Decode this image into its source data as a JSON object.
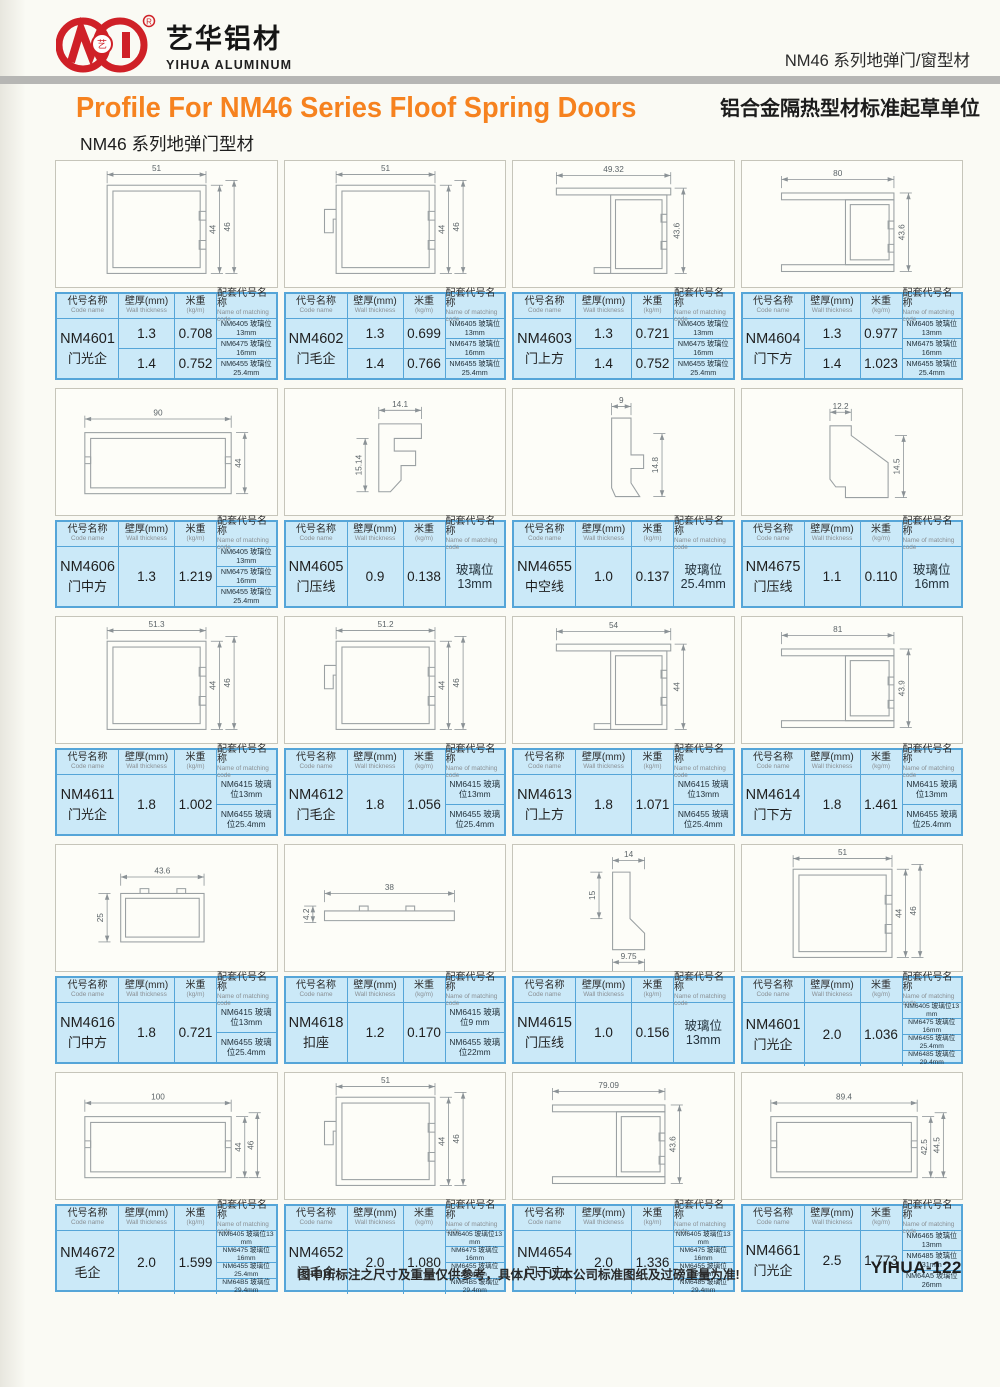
{
  "brand": {
    "company_cn": "艺华铝材",
    "company_en": "YIHUA ALUMINUM",
    "registered": "®"
  },
  "header": {
    "right_line1": "NM46 系列地弹门/窗型材",
    "right_line2": "铝合金隔热型材标准起草单位",
    "title": "Profile For NM46 Series Floof Spring Doors",
    "subtitle": "NM46 系列地弹门型材"
  },
  "table_headers": {
    "col1_cn": "代号名称",
    "col1_en": "Code name",
    "col2_cn": "壁厚(mm)",
    "col2_en": "Wall thickness",
    "col3_cn": "米重",
    "col3_en": "(kg/m)",
    "col4_cn": "配套代号名称",
    "col4_en": "Name of matching code"
  },
  "colors": {
    "accent_orange": "#f6821f",
    "brand_red": "#cf2027",
    "table_bg": "#cbe9f8",
    "table_border": "#55a5d8",
    "gray_bar": "#b6b6b4"
  },
  "footer": {
    "note": "图中所标注之尺寸及重量仅供参考，具体尺寸以本公司标准图纸及过磅重量为准!",
    "page_code": "YIHUA-122"
  },
  "cells": [
    {
      "code": "NM4601",
      "name": "门光企",
      "thickness": [
        "1.3",
        "1.4"
      ],
      "weight": [
        "0.708",
        "0.752"
      ],
      "matching": {
        "style": "list",
        "items": [
          "NM6405 玻璃位13mm",
          "NM6475 玻璃位16mm",
          "NM6455 玻璃位25.4mm"
        ]
      },
      "drawing": {
        "shape": "sqtube",
        "top": "51",
        "right": [
          "44",
          "46"
        ]
      }
    },
    {
      "code": "NM4602",
      "name": "门毛企",
      "thickness": [
        "1.3",
        "1.4"
      ],
      "weight": [
        "0.699",
        "0.766"
      ],
      "matching": {
        "style": "list",
        "items": [
          "NM6405 玻璃位13mm",
          "NM6475 玻璃位16mm",
          "NM6455 玻璃位25.4mm"
        ]
      },
      "drawing": {
        "shape": "sqtube_hook",
        "top": "51",
        "right": [
          "44",
          "46"
        ]
      }
    },
    {
      "code": "NM4603",
      "name": "门上方",
      "thickness": [
        "1.3",
        "1.4"
      ],
      "weight": [
        "0.721",
        "0.752"
      ],
      "matching": {
        "style": "list",
        "items": [
          "NM6405 玻璃位13mm",
          "NM6475 玻璃位16mm",
          "NM6455 玻璃位25.4mm"
        ]
      },
      "drawing": {
        "shape": "tflange",
        "top": "49.32",
        "right": [
          "43.6"
        ]
      }
    },
    {
      "code": "NM4604",
      "name": "门下方",
      "thickness": [
        "1.3",
        "1.4"
      ],
      "weight": [
        "0.977",
        "1.023"
      ],
      "matching": {
        "style": "list",
        "items": [
          "NM6405 玻璃位13mm",
          "NM6475 玻璃位16mm",
          "NM6455 玻璃位25.4mm"
        ]
      },
      "drawing": {
        "shape": "dflange",
        "top": "80",
        "right": [
          "43.6"
        ]
      }
    },
    {
      "code": "NM4606",
      "name": "门中方",
      "thickness": [
        "1.3"
      ],
      "weight": [
        "1.219"
      ],
      "matching": {
        "style": "list",
        "items": [
          "NM6405 玻璃位13mm",
          "NM6475 玻璃位16mm",
          "NM6455 玻璃位25.4mm"
        ]
      },
      "drawing": {
        "shape": "wtube",
        "top": "90",
        "right": [
          "44"
        ]
      }
    },
    {
      "code": "NM4605",
      "name": "门压线",
      "thickness": [
        "0.9"
      ],
      "weight": [
        "0.138"
      ],
      "matching": {
        "style": "single",
        "items": [
          "玻璃位13mm"
        ]
      },
      "drawing": {
        "shape": "clip",
        "top": "14.1",
        "left": "15.14"
      }
    },
    {
      "code": "NM4655",
      "name": "中空线",
      "thickness": [
        "1.0"
      ],
      "weight": [
        "0.137"
      ],
      "matching": {
        "style": "single",
        "items": [
          "玻璃位25.4mm"
        ]
      },
      "drawing": {
        "shape": "hollow",
        "top": "9",
        "right": [
          "14.8"
        ]
      }
    },
    {
      "code": "NM4675",
      "name": "门压线",
      "thickness": [
        "1.1"
      ],
      "weight": [
        "0.110"
      ],
      "matching": {
        "style": "single",
        "items": [
          "玻璃位16mm"
        ]
      },
      "drawing": {
        "shape": "slant",
        "top": "12.2",
        "right": [
          "14.5"
        ]
      }
    },
    {
      "code": "NM4611",
      "name": "门光企",
      "thickness": [
        "1.8"
      ],
      "weight": [
        "1.002"
      ],
      "matching": {
        "style": "list",
        "items": [
          "NM6415 玻璃位13mm",
          "NM6455 玻璃位25.4mm"
        ]
      },
      "drawing": {
        "shape": "sqtube",
        "top": "51.3",
        "right": [
          "44",
          "46"
        ]
      }
    },
    {
      "code": "NM4612",
      "name": "门毛企",
      "thickness": [
        "1.8"
      ],
      "weight": [
        "1.056"
      ],
      "matching": {
        "style": "list",
        "items": [
          "NM6415 玻璃位13mm",
          "NM6455 玻璃位25.4mm"
        ]
      },
      "drawing": {
        "shape": "sqtube_hook",
        "top": "51.2",
        "right": [
          "44",
          "46"
        ]
      }
    },
    {
      "code": "NM4613",
      "name": "门上方",
      "thickness": [
        "1.8"
      ],
      "weight": [
        "1.071"
      ],
      "matching": {
        "style": "list",
        "items": [
          "NM6415 玻璃位13mm",
          "NM6455 玻璃位25.4mm"
        ]
      },
      "drawing": {
        "shape": "tflange",
        "top": "54",
        "right": [
          "44"
        ]
      }
    },
    {
      "code": "NM4614",
      "name": "门下方",
      "thickness": [
        "1.8"
      ],
      "weight": [
        "1.461"
      ],
      "matching": {
        "style": "list",
        "items": [
          "NM6415 玻璃位13mm",
          "NM6455 玻璃位25.4mm"
        ]
      },
      "drawing": {
        "shape": "dflange",
        "top": "81",
        "right": [
          "43.9"
        ]
      }
    },
    {
      "code": "NM4616",
      "name": "门中方",
      "thickness": [
        "1.8"
      ],
      "weight": [
        "0.721"
      ],
      "matching": {
        "style": "list",
        "items": [
          "NM6415 玻璃位13mm",
          "NM6455 玻璃位25.4mm"
        ]
      },
      "drawing": {
        "shape": "midtube",
        "top": "43.6",
        "left": "25"
      }
    },
    {
      "code": "NM4618",
      "name": "扣座",
      "thickness": [
        "1.2"
      ],
      "weight": [
        "0.170"
      ],
      "matching": {
        "style": "list",
        "items": [
          "NM6415 玻璃位9 mm",
          "NM6455 玻璃位22mm"
        ]
      },
      "drawing": {
        "shape": "flat",
        "top": "38",
        "left": "4.2"
      }
    },
    {
      "code": "NM4615",
      "name": "门压线",
      "thickness": [
        "1.0"
      ],
      "weight": [
        "0.156"
      ],
      "matching": {
        "style": "single",
        "items": [
          "玻璃位13mm"
        ]
      },
      "drawing": {
        "shape": "presser",
        "top": "14",
        "left": "15",
        "bottom": "9.75"
      }
    },
    {
      "code": "NM4601",
      "name": "门光企",
      "thickness": [
        "2.0"
      ],
      "weight": [
        "1.036"
      ],
      "matching": {
        "style": "list",
        "items": [
          "NM6405 玻璃位13 mm",
          "NM6475 玻璃位16mm",
          "NM6455 玻璃位25.4mm",
          "NM6485 玻璃位29.4mm"
        ]
      },
      "drawing": {
        "shape": "sqtube",
        "top": "51",
        "right": [
          "44",
          "46"
        ]
      }
    },
    {
      "code": "NM4672",
      "name": "毛企",
      "thickness": [
        "2.0"
      ],
      "weight": [
        "1.599"
      ],
      "matching": {
        "style": "list",
        "items": [
          "NM6405 玻璃位13 mm",
          "NM6475 玻璃位16mm",
          "NM6455 玻璃位25.4mm",
          "NM64B5 玻璃位29.4mm"
        ]
      },
      "drawing": {
        "shape": "wtube",
        "top": "100",
        "right": [
          "44",
          "46"
        ]
      }
    },
    {
      "code": "NM4652",
      "name": "门毛企",
      "thickness": [
        "2.0"
      ],
      "weight": [
        "1.080"
      ],
      "matching": {
        "style": "list",
        "items": [
          "NM6405 玻璃位13 mm",
          "NM6475 玻璃位16mm",
          "NM6455 玻璃位25.4mm",
          "NM64B5 玻璃位29.4mm"
        ]
      },
      "drawing": {
        "shape": "sqtube_hook",
        "top": "51",
        "right": [
          "44",
          "46"
        ]
      }
    },
    {
      "code": "NM4654",
      "name": "门下方",
      "thickness": [
        "2.0"
      ],
      "weight": [
        "1.336"
      ],
      "matching": {
        "style": "list",
        "items": [
          "NM6405 玻璃位13 mm",
          "NM6475 玻璃位16mm",
          "NM6455 玻璃位25.4mm",
          "NM6485 玻璃位29.4mm"
        ]
      },
      "drawing": {
        "shape": "dflange",
        "top": "79.09",
        "right": [
          "43.6"
        ]
      }
    },
    {
      "code": "NM4661",
      "name": "门光企",
      "thickness": [
        "2.5"
      ],
      "weight": [
        "1.773"
      ],
      "matching": {
        "style": "list",
        "items": [
          "NM6465 玻璃位13mm",
          "NM6485 玻璃位31mm",
          "NM64A5 玻璃位26mm"
        ]
      },
      "drawing": {
        "shape": "wtube",
        "top": "89.4",
        "right": [
          "42.5",
          "44.5"
        ]
      }
    }
  ]
}
